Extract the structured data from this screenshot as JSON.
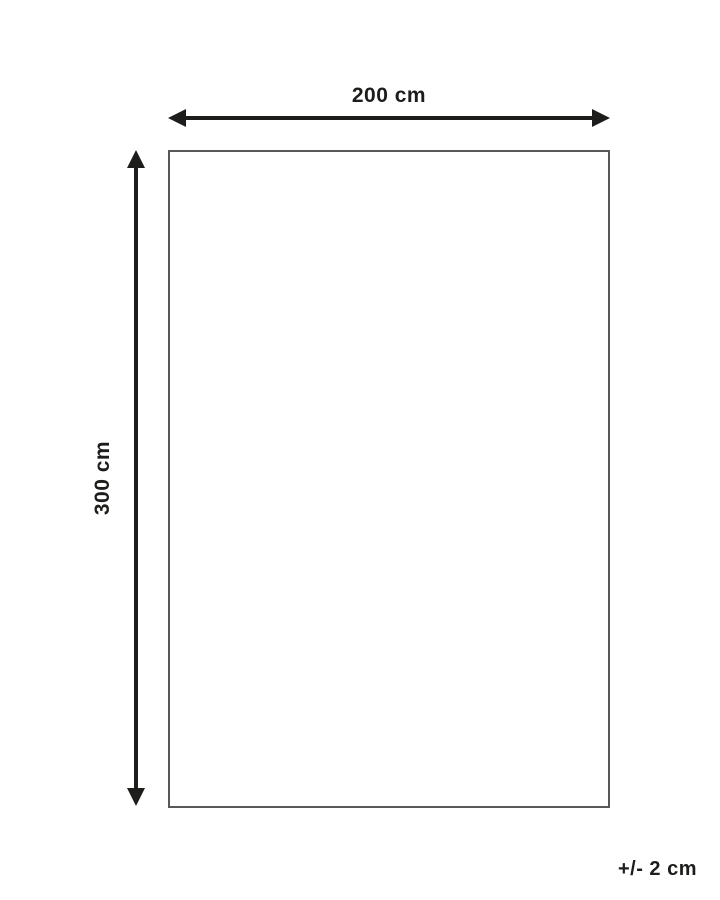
{
  "diagram": {
    "type": "product-dimension-diagram",
    "width_label": "200 cm",
    "height_label": "300 cm",
    "tolerance_label": "+/- 2 cm",
    "dimensions": {
      "width_cm": 200,
      "height_cm": 300,
      "tolerance_cm": 2
    },
    "colors": {
      "arrow": "#1d1d1b",
      "text": "#1d1d1b",
      "rect_border": "#58585a",
      "background": "#ffffff"
    }
  }
}
